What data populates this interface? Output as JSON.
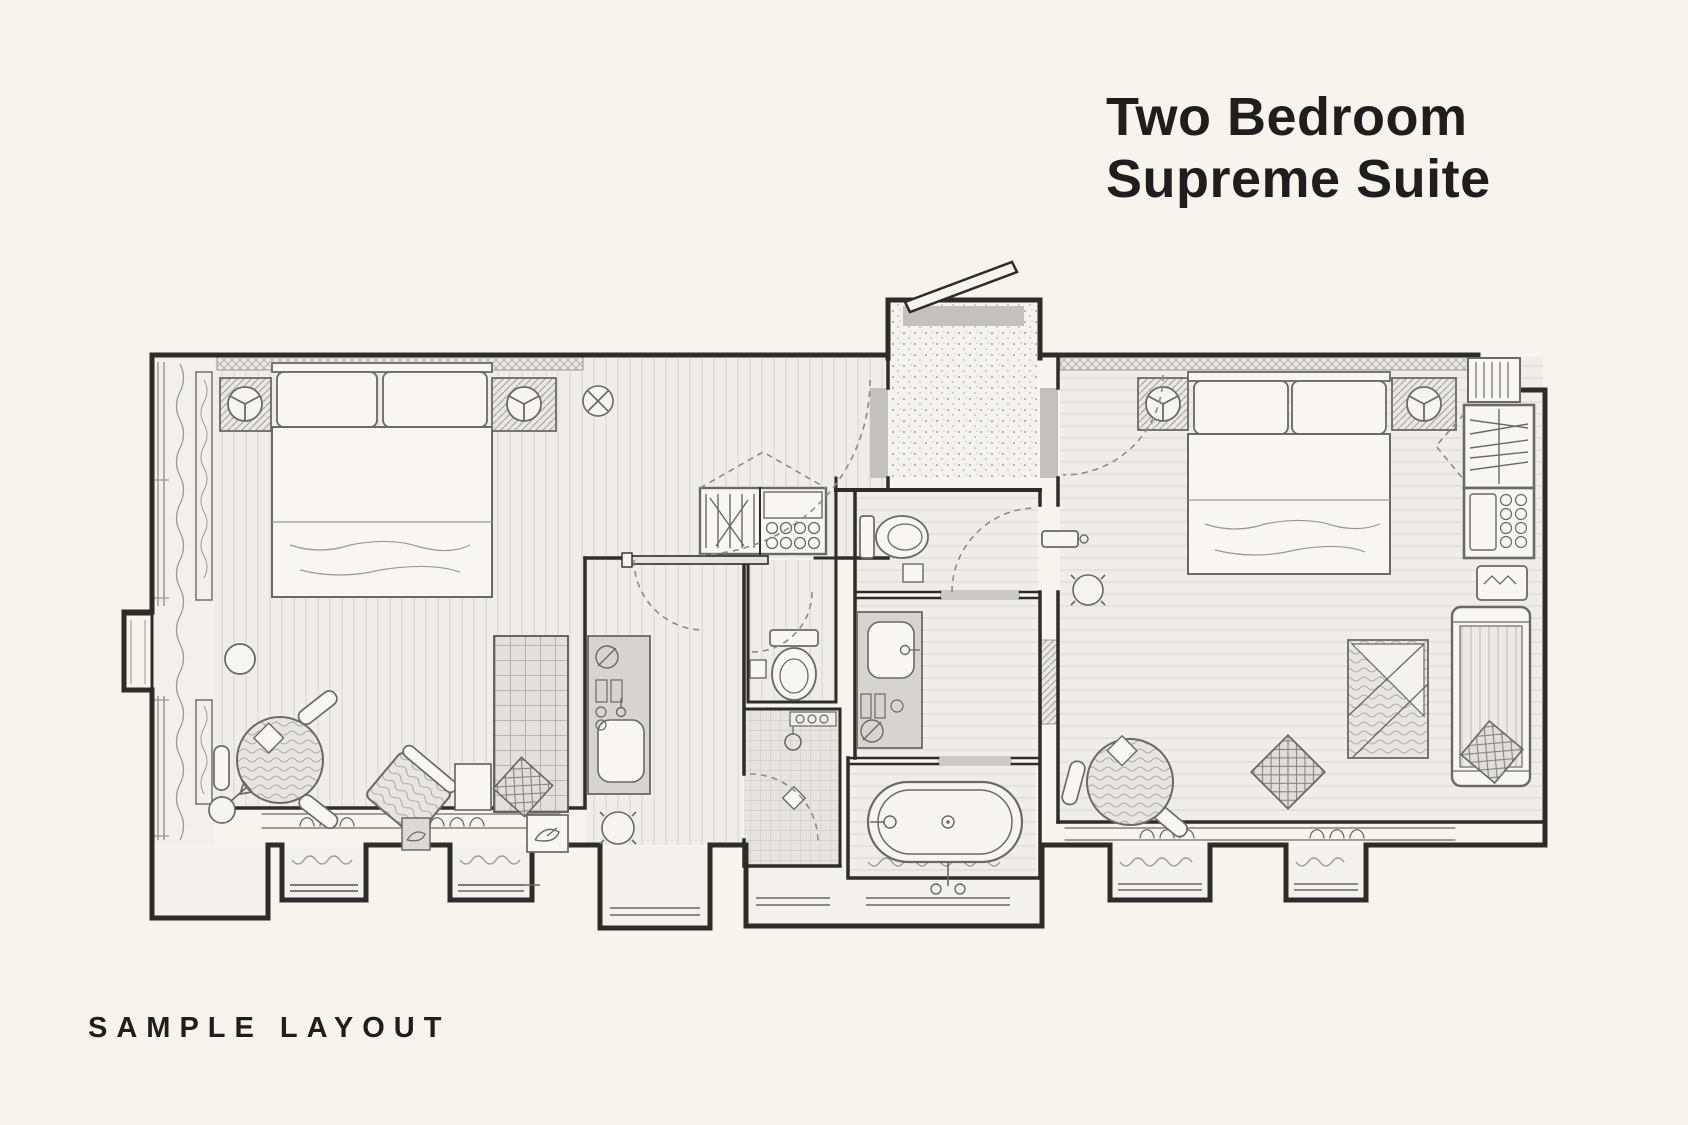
{
  "header": {
    "title_line1": "Two Bedroom",
    "title_line2": "Supreme Suite"
  },
  "footer": {
    "label": "SAMPLE LAYOUT"
  },
  "colors": {
    "background": "#f7f3ed",
    "ink": "#1f1e1c",
    "wall": "#2e2c29",
    "floor": "#eeedea",
    "threshold": "#c3c1bd",
    "furniture_line": "#6b6965"
  },
  "floorplan": {
    "type": "hotel-suite-plan",
    "rooms": [
      "bedroom-left",
      "corridor",
      "closet",
      "bathroom-left",
      "wc",
      "shower",
      "entry-vestibule",
      "toilet-room",
      "vanity-room",
      "bathtub-room",
      "bedroom-right"
    ],
    "fixtures": [
      "king-bed-left",
      "king-bed-right",
      "nightstand-lamps",
      "round-dining-table",
      "armchair",
      "ottoman",
      "area-rug",
      "floor-lamp",
      "wardrobe",
      "minibar",
      "sofa",
      "bench",
      "freestanding-bathtub",
      "vanity-sink",
      "toilet",
      "walk-in-shower",
      "bay-windows",
      "radiators",
      "entry-door"
    ]
  }
}
